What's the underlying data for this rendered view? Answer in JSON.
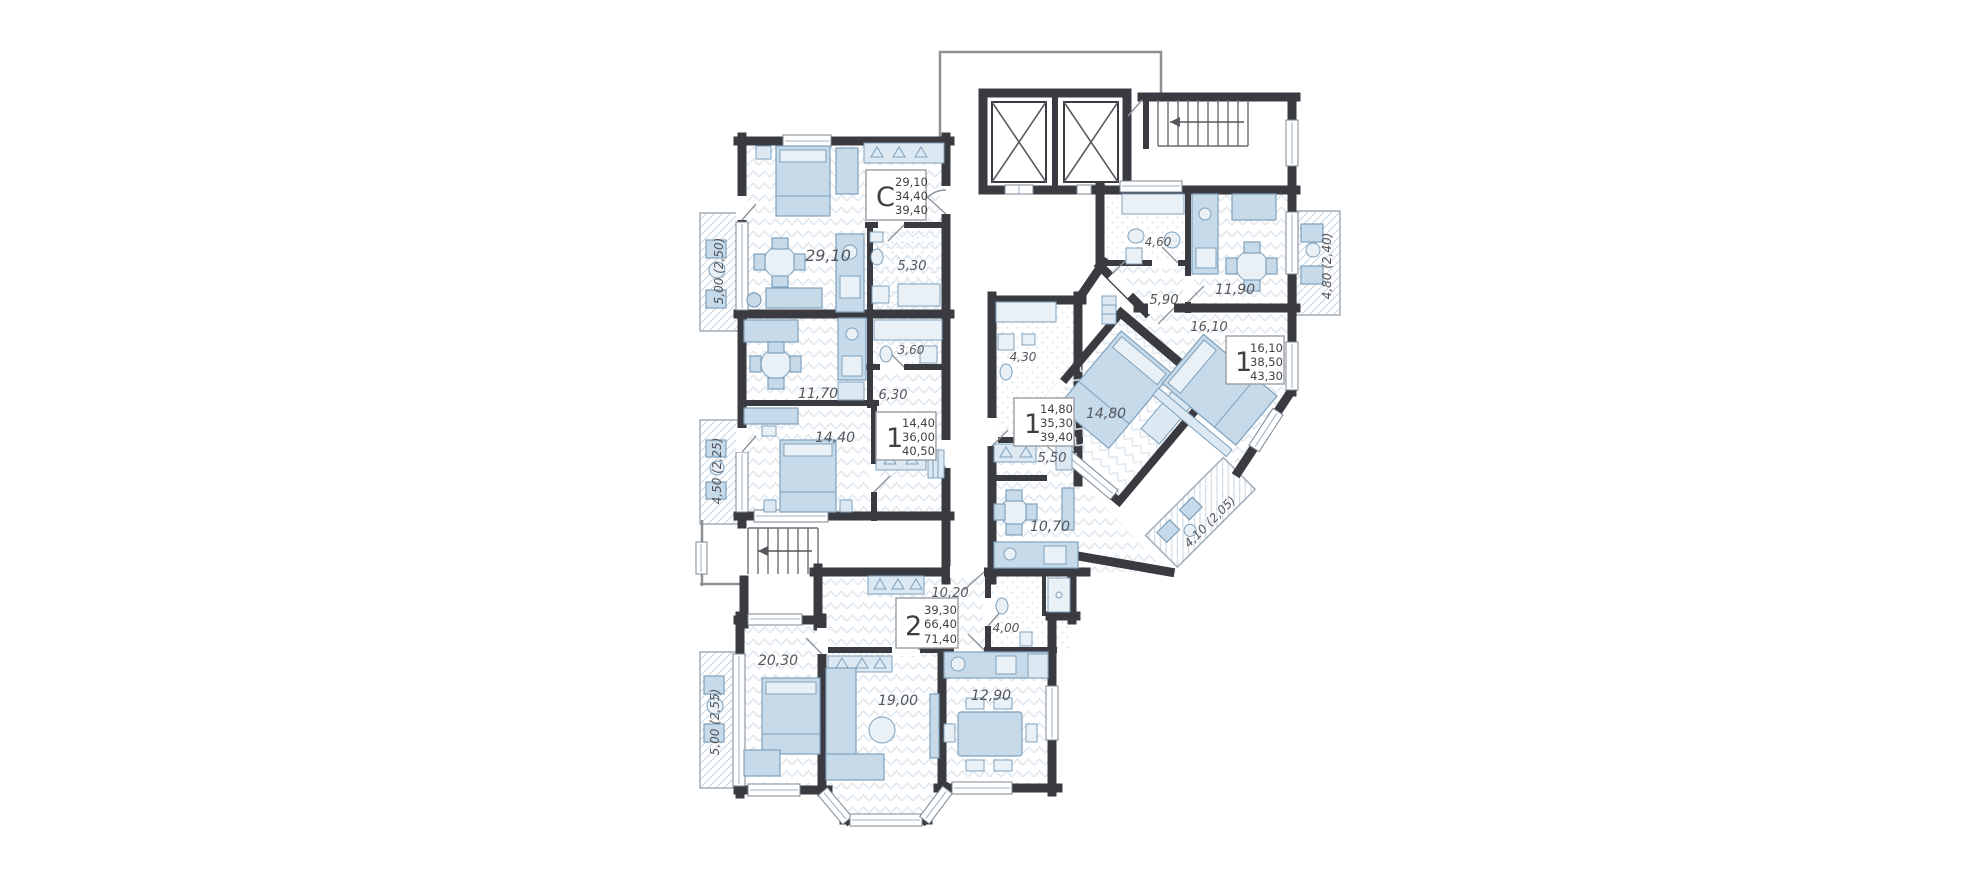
{
  "plan": {
    "name": "Residential floor plan",
    "wall_color": "#3a3b40",
    "furniture_color": "#c6daea",
    "floor_hatch_color": "#dfe8f0",
    "label_color": "#54565b"
  },
  "apartments": [
    {
      "id": "studio-top-left",
      "type": "C",
      "areas": [
        "29,10",
        "34,40",
        "39,40"
      ]
    },
    {
      "id": "one-room-left",
      "type": "1",
      "areas": [
        "14,40",
        "36,00",
        "40,50"
      ]
    },
    {
      "id": "one-room-center",
      "type": "1",
      "areas": [
        "14,80",
        "35,30",
        "39,40"
      ]
    },
    {
      "id": "one-room-right",
      "type": "1",
      "areas": [
        "16,10",
        "38,50",
        "43,30"
      ]
    },
    {
      "id": "two-room-bottom",
      "type": "2",
      "areas": [
        "39,30",
        "66,40",
        "71,40"
      ]
    }
  ],
  "rooms": [
    {
      "name": "studio-living-kitchen",
      "area": "29,10"
    },
    {
      "name": "studio-bathroom",
      "area": "5,30"
    },
    {
      "name": "left-kitchen-living",
      "area": "11,70"
    },
    {
      "name": "left-bathroom",
      "area": "3,60"
    },
    {
      "name": "left-hallway",
      "area": "6,30"
    },
    {
      "name": "left-bedroom",
      "area": "14,40"
    },
    {
      "name": "center-bathroom",
      "area": "4,30"
    },
    {
      "name": "center-hallway",
      "area": "5,50"
    },
    {
      "name": "center-kitchen-living",
      "area": "10,70"
    },
    {
      "name": "center-bedroom",
      "area": "14,80"
    },
    {
      "name": "right-bathroom",
      "area": "4,60"
    },
    {
      "name": "right-kitchen-living",
      "area": "11,90"
    },
    {
      "name": "right-hallway",
      "area": "5,90"
    },
    {
      "name": "right-bedroom",
      "area": "16,10"
    },
    {
      "name": "bottom-hallway",
      "area": "10,20"
    },
    {
      "name": "bottom-bathroom",
      "area": "4,00"
    },
    {
      "name": "bottom-bedroom",
      "area": "20,30"
    },
    {
      "name": "bottom-living",
      "area": "19,00"
    },
    {
      "name": "bottom-kitchen",
      "area": "12,90"
    }
  ],
  "balconies": [
    {
      "name": "balcony-left-top",
      "label": "5,00 (2,50)"
    },
    {
      "name": "balcony-left-middle",
      "label": "4,50 (2,25)"
    },
    {
      "name": "balcony-left-bottom",
      "label": "5,00 (2,55)"
    },
    {
      "name": "balcony-right-top",
      "label": "4,80 (2,40)"
    },
    {
      "name": "balcony-diagonal",
      "label": "4,10 (2,05)"
    }
  ]
}
